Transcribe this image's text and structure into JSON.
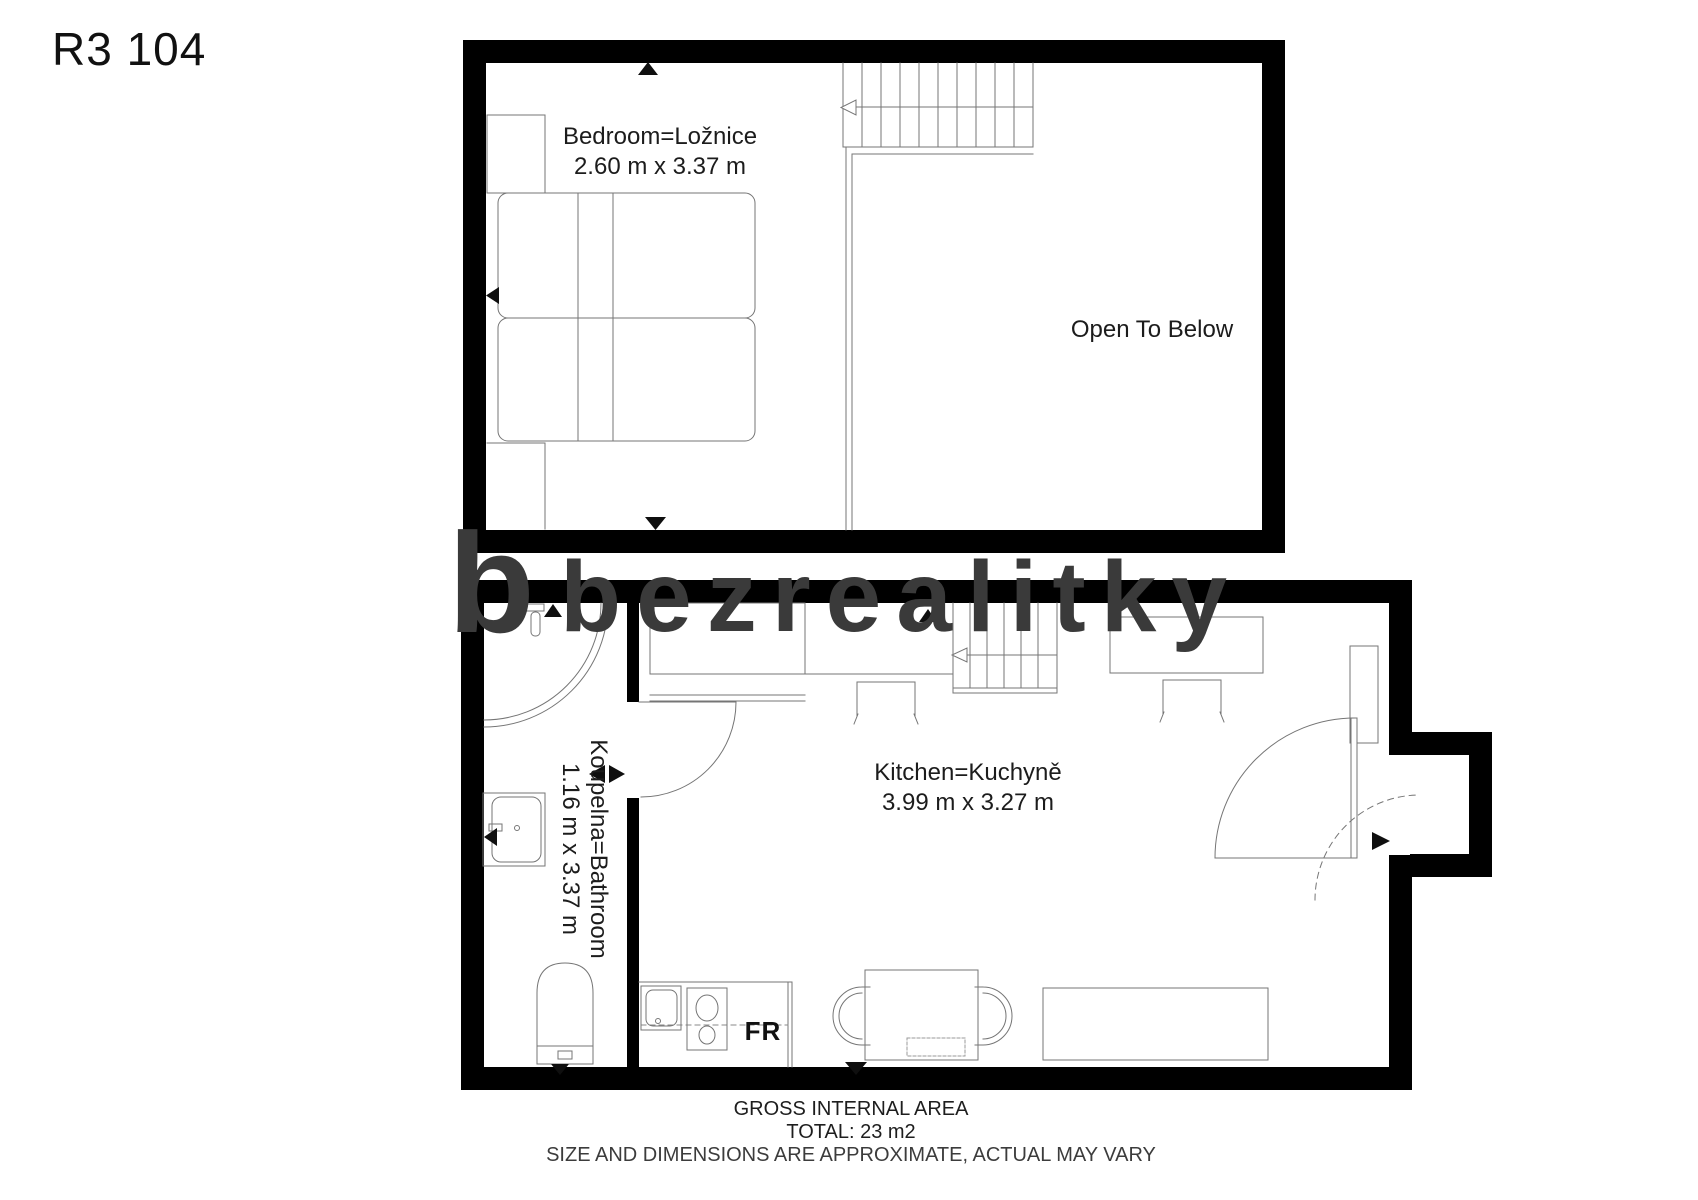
{
  "title": "R3 104",
  "watermark": {
    "logo_letter": "b",
    "brand": "bezrealitky"
  },
  "upper_floor": {
    "bedroom_label": "Bedroom=Ložnice",
    "bedroom_dimensions": "2.60 m x 3.37 m",
    "open_to_below_label": "Open To Below"
  },
  "lower_floor": {
    "bathroom_label": "Koupelna=Bathroom",
    "bathroom_dimensions": "1.16 m x 3.37 m",
    "kitchen_label": "Kitchen=Kuchyně",
    "kitchen_dimensions": "3.99 m x 3.27 m",
    "fridge_label": "FR"
  },
  "footer": {
    "area_title": "GROSS INTERNAL AREA",
    "total": "TOTAL: 23 m2",
    "disclaimer": "SIZE AND DIMENSIONS ARE APPROXIMATE, ACTUAL MAY VARY"
  },
  "colors": {
    "wall": "#000000",
    "line": "#757575",
    "watermark": "#3a3a3a"
  }
}
